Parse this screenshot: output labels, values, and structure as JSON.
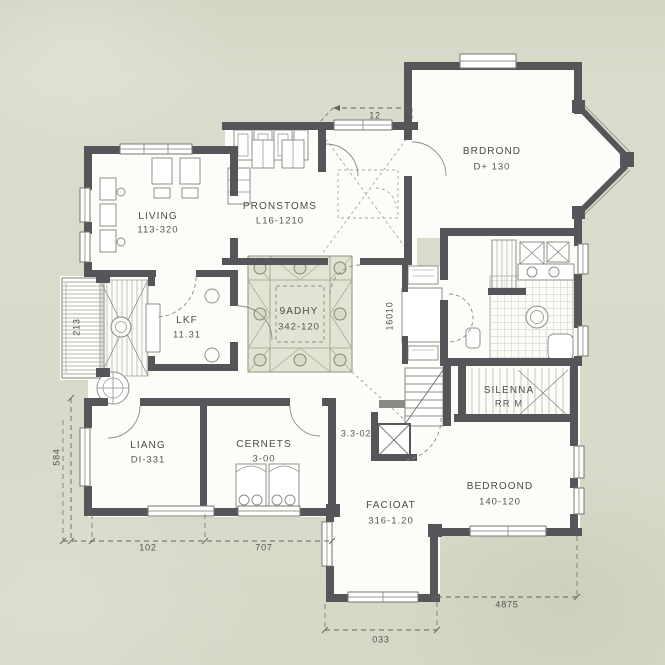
{
  "colors": {
    "paper": "#d8dbc9",
    "wall": "#56565a",
    "courtyard_fill": "#e1e4d2",
    "floor_fill": "#fcfcf9",
    "ink": "#4b4b45"
  },
  "rooms": {
    "living_top": {
      "name": "LIVING",
      "dims": "113-320"
    },
    "pronstoms": {
      "name": "PRONSTOMS",
      "dims": "L16-1210"
    },
    "brdrond": {
      "name": "BRDROND",
      "dims": "D+ 130"
    },
    "courtyard": {
      "name": "9ADHY",
      "dims": "342-120"
    },
    "lkf": {
      "name": "LKF",
      "dims": "11.31"
    },
    "liang": {
      "name": "LIANG",
      "dims": "DI-331"
    },
    "cernets": {
      "name": "CERNETS",
      "dims": "3-00"
    },
    "facioat": {
      "name": "FACIOAT",
      "dims": "316-1.20"
    },
    "bedroond": {
      "name": "BEDROOND",
      "dims": "140-120"
    },
    "silenna": {
      "name": "SILENNA",
      "dims": "RR M"
    }
  },
  "annotations": {
    "stair_area": "3.3-02",
    "entry_width": "12",
    "dim_bottom_left_1": "102",
    "dim_bottom_left_2": "707",
    "dim_porch": "033",
    "dim_bottom_right": "4875",
    "dim_left_side": "584",
    "dim_deck": "213",
    "dim_hall": "16010"
  }
}
